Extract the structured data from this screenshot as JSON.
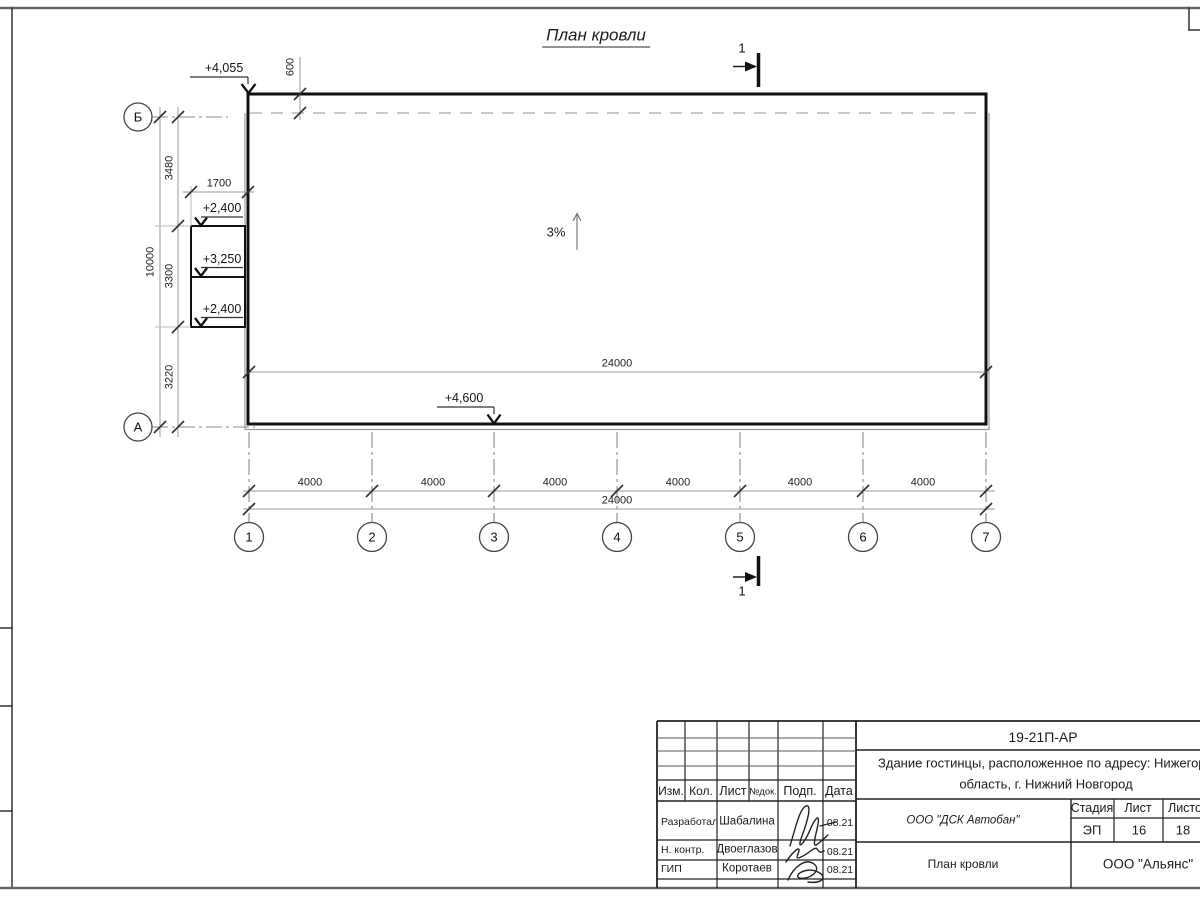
{
  "title": "План кровли",
  "section_mark": {
    "label": "1"
  },
  "slope_label": "3%",
  "elevations": {
    "roof_corner": "+4,055",
    "annex_top": "+2,400",
    "annex_mid": "+3,250",
    "annex_bot": "+2,400",
    "entry": "+4,600"
  },
  "dims": {
    "overhang": "600",
    "annex_width": "1700",
    "left_total": "10000",
    "seg_top": "3480",
    "seg_mid": "3300",
    "seg_bot": "3220",
    "bay": "4000",
    "total": "24000"
  },
  "axes_h": [
    "1",
    "2",
    "3",
    "4",
    "5",
    "6",
    "7"
  ],
  "axes_v": {
    "bottom": "А",
    "top": "Б"
  },
  "stamp": {
    "doc_number": "19-21П-АР",
    "object_line1": "Здание гостинцы, расположенное по адресу: Нижегородская",
    "object_line2": "область, г. Нижний Новгород",
    "header": {
      "izm": "Изм.",
      "kol": "Кол.",
      "list": "Лист",
      "ndoc": "№док.",
      "podp": "Подп.",
      "data": "Дата"
    },
    "rows": [
      {
        "role": "Разработал",
        "name": "Шабалина",
        "date": "08.21"
      },
      {
        "role": "Н. контр.",
        "name": "Двоеглазов",
        "date": "08.21"
      },
      {
        "role": "ГИП",
        "name": "Коротаев",
        "date": "08.21"
      }
    ],
    "company": "ООО \"ДСК Автобан\"",
    "stage_label": "Стадия",
    "stage": "ЭП",
    "sheet_label": "Лист",
    "sheet": "16",
    "sheets_label": "Листов",
    "sheets": "18",
    "sheet_title": "План кровли",
    "firm": "ООО \"Альянс\""
  },
  "colors": {
    "ink": "#1a1a1a",
    "thin_line": "#999999",
    "hidden_line": "#b5b5b5",
    "paper": "#ffffff"
  }
}
